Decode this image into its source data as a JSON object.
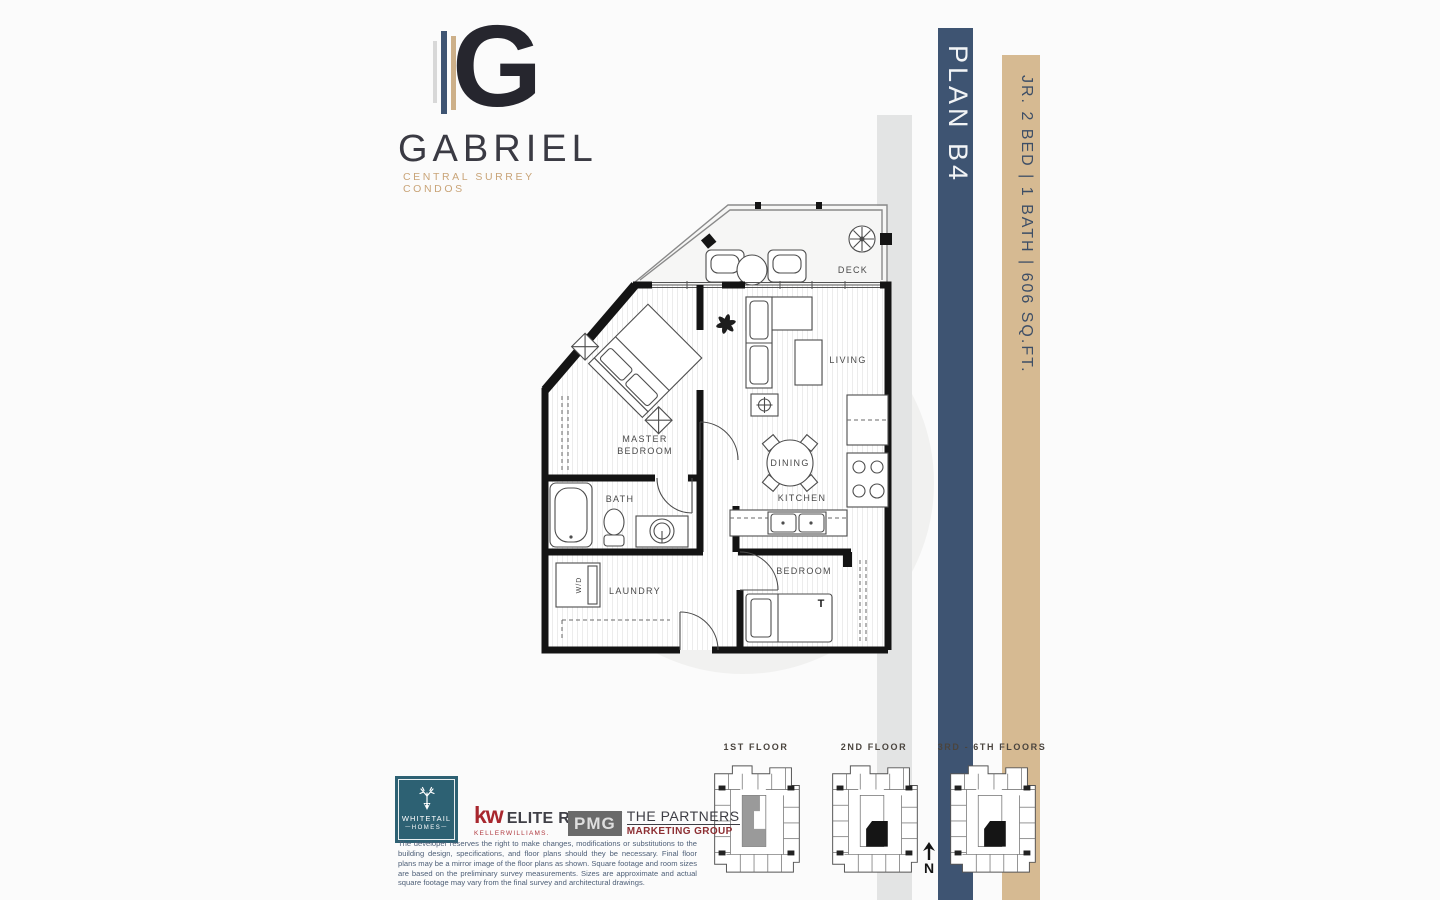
{
  "brand": {
    "logo_letter": "G",
    "name": "GABRIEL",
    "tagline": "CENTRAL SURREY CONDOS"
  },
  "side_bars": {
    "plan_label": "PLAN B4",
    "specs_label": "JR. 2 BED | 1 BATH | 606 SQ.FT."
  },
  "floorplan": {
    "rooms": {
      "deck": "DECK",
      "living": "LIVING",
      "master_line1": "MASTER",
      "master_line2": "BEDROOM",
      "dining": "DINING",
      "kitchen": "KITCHEN",
      "bath": "BATH",
      "laundry": "LAUNDRY",
      "washer_dryer": "W/D",
      "bedroom": "BEDROOM",
      "bed_size_tag": "T"
    }
  },
  "keyplans": {
    "first_label": "1ST FLOOR",
    "second_label": "2ND FLOOR",
    "upper_label": "3RD - 6TH FLOORS",
    "north_label": "N"
  },
  "logos": {
    "whitetail": {
      "line1": "WHITETAIL",
      "line2": "HOMES"
    },
    "kw": {
      "mark": "kw",
      "name": "ELITE REALTY",
      "sub": "KELLERWILLIAMS."
    },
    "pmg": {
      "mark": "PMG",
      "line1": "THE PARTNERS",
      "line2": "MARKETING GROUP"
    }
  },
  "disclaimer": "The developer reserves the right to make changes, modifications or substitutions to the building design, specifications, and floor plans should they be necessary. Final floor plans may be a mirror image of the floor plans as shown. Square footage and room sizes are based on the preliminary survey measurements. Sizes are approximate and actual square footage may vary from the final survey and architectural drawings.",
  "colors": {
    "plan_bar": "#3e5472",
    "specs_bar": "#d6ba92",
    "shadow_bar": "#e3e4e4",
    "brand_tan": "#c9a478",
    "whitetail_teal": "#2d6173",
    "kw_red": "#a8272e"
  }
}
